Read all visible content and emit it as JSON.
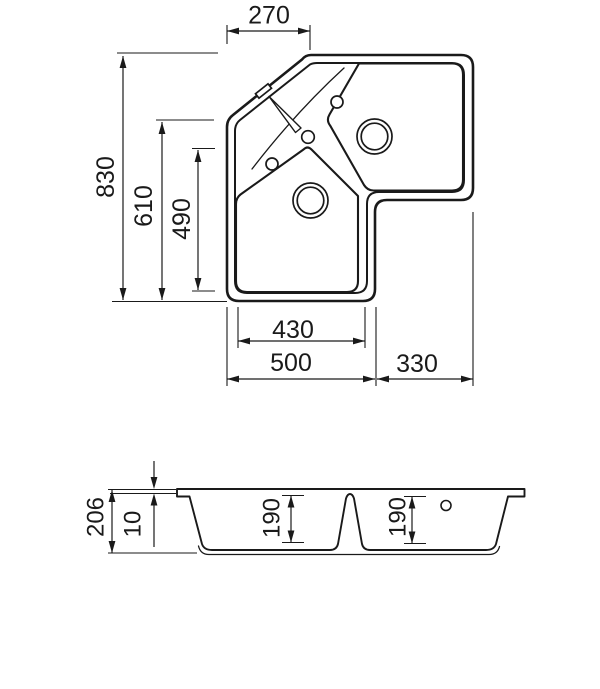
{
  "drawing": {
    "top_view": {
      "width_top_corner": "270",
      "height_total": "830",
      "height_left_edge": "610",
      "height_lower_bowl": "490",
      "width_bowl_inner": "430",
      "width_main_section": "500",
      "width_right_wing": "330"
    },
    "section_view": {
      "height_total": "206",
      "rim_thickness": "10",
      "depth_left_bowl": "190",
      "depth_right_bowl": "190"
    }
  },
  "colors": {
    "line": "#1a1a1a",
    "background": "#ffffff"
  }
}
